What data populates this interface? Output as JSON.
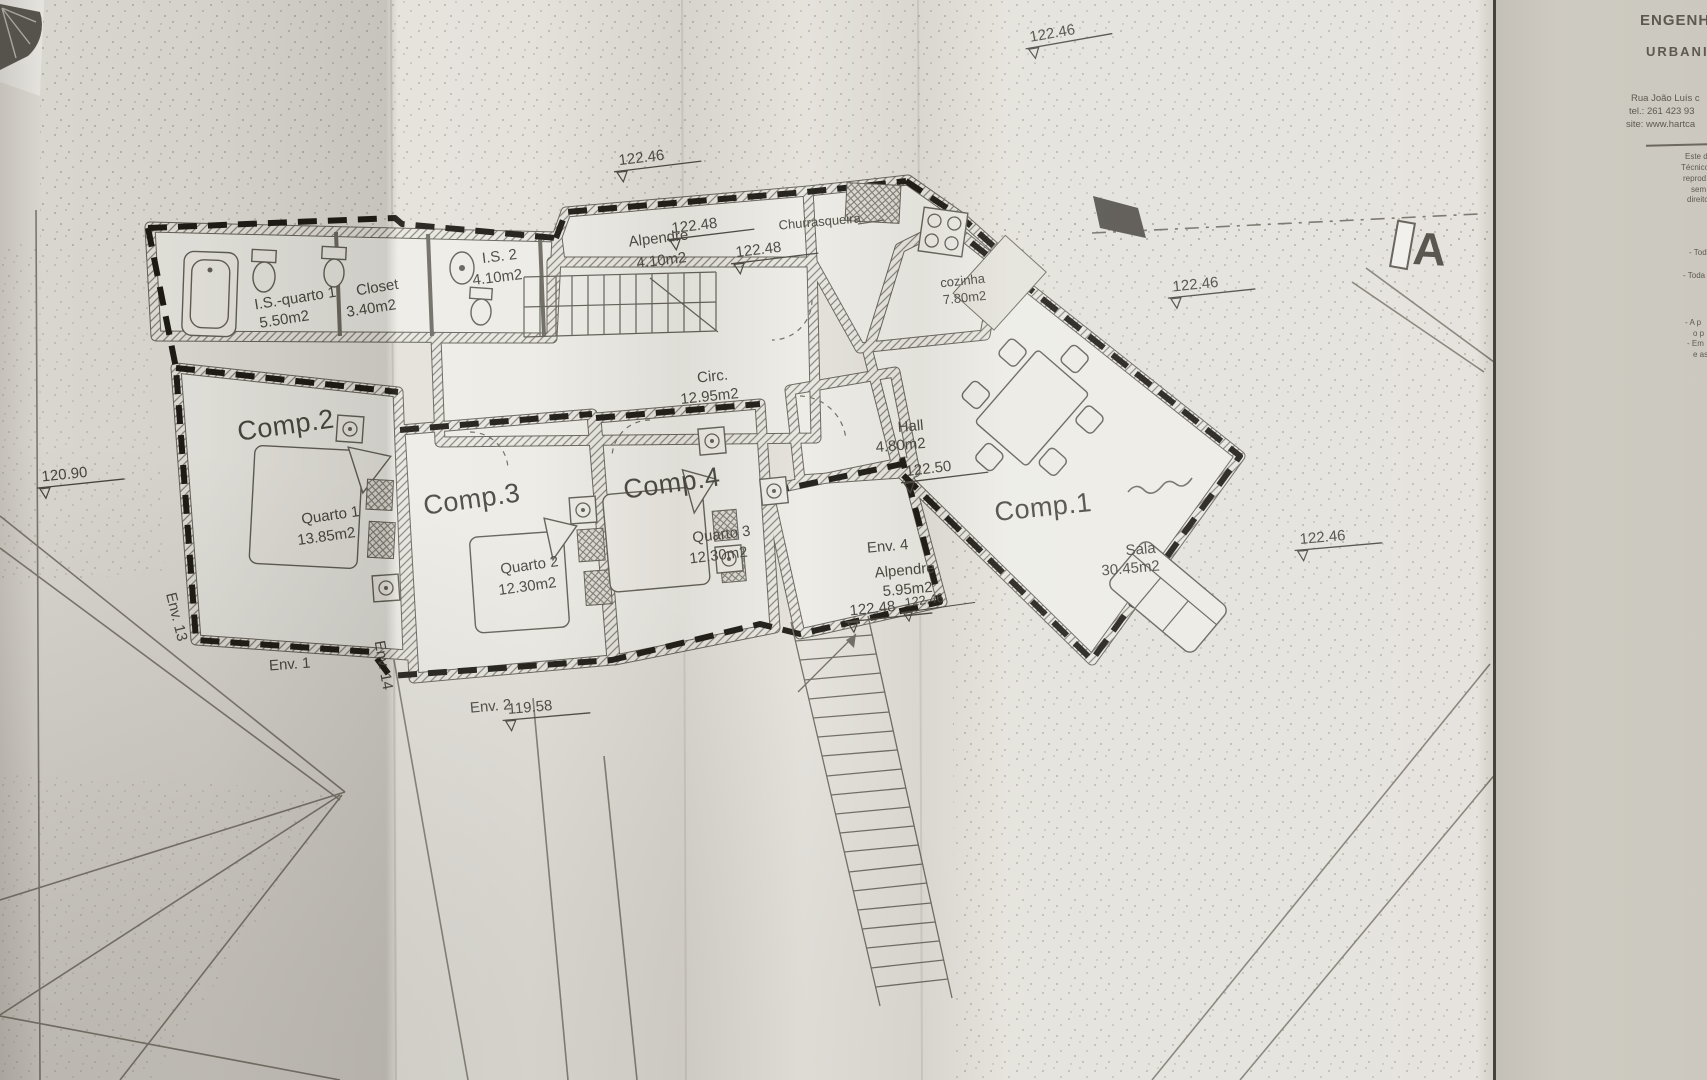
{
  "section_label": "A",
  "title_block": {
    "heading1": "ENGENHA",
    "heading2": "URBANIS",
    "address1": "Rua João Luís c",
    "address2": "tel.: 261 423 93",
    "address3": "site: www.hartca",
    "note1": "Este d",
    "note2": "Técnico",
    "note3": "reprod",
    "note4": "sem",
    "note5": "direito",
    "bullet1": "- Tod",
    "bullet2": "- Toda",
    "bullet3": "- A p",
    "bullet4": "o p",
    "bullet5": "- Em",
    "bullet6": "e as"
  },
  "rooms": {
    "is_quarto1_name": "I.S.-quarto 1",
    "is_quarto1_area": "5.50m2",
    "closet_name": "Closet",
    "closet_area": "3.40m2",
    "is2_name": "I.S. 2",
    "is2_area": "4.10m2",
    "alpendre1_name": "Alpendre",
    "alpendre1_area": "4.10m2",
    "churrasqueira_name": "Churrasqueira",
    "cozinha_name": "cozinha",
    "cozinha_area": "7.80m2",
    "circ_name": "Circ.",
    "circ_area": "12.95m2",
    "hall_name": "Hall",
    "hall_area": "4.80m2",
    "comp1_name": "Comp.1",
    "sala_name": "Sala",
    "sala_area": "30.45m2",
    "comp2_name": "Comp.2",
    "quarto1_name": "Quarto 1",
    "quarto1_area": "13.85m2",
    "comp3_name": "Comp.3",
    "quarto2_name": "Quarto 2",
    "quarto2_area": "12.30m2",
    "comp4_name": "Comp.4",
    "quarto3_name": "Quarto 3",
    "quarto3_area": "12.30m2",
    "env4_name": "Env. 4",
    "alpendre2_name": "Alpendre",
    "alpendre2_area": "5.95m2"
  },
  "envelopes": {
    "env13": "Env. 13",
    "env1": "Env. 1",
    "env14": "Env. 14",
    "env2": "Env. 2"
  },
  "elevations": {
    "top": "122.46",
    "upper_left": "122.46",
    "alpendre_upper": "122.48",
    "alpendre_lower": "122.48",
    "right_upper": "122.46",
    "hall": "122.50",
    "porch": "122.48",
    "center": "122.46",
    "right_mid": "122.46",
    "left": "120.90",
    "bottom": "119.58"
  },
  "colors": {
    "ink": "#45423c",
    "bold_wall": "#17140f",
    "paper": "#e3e0da"
  }
}
